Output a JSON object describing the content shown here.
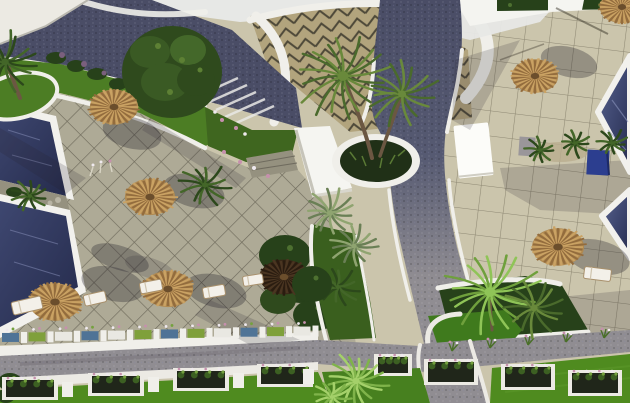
{
  "palette": {
    "sky": "#e7e8e6",
    "roofWhite": "#f5f5f1",
    "buildingWhite": "#eceae3",
    "roadDark": "#4a4d66",
    "gravel": "#908d92",
    "tileRBg": "#cbc5ac",
    "tileRLine": "#8e8873",
    "tileLBg": "#aeaa96",
    "tileLLine": "#6f6b5c",
    "chevBg": "#b2a47d",
    "chevLine": "#4e4939",
    "wallWhite": "#f0efea",
    "curbWhite": "#eceae4",
    "lawn": "#4c7d24",
    "lawnDark": "#3f661f",
    "lawnBright": "#4f8b1f",
    "hedge": "#27411a",
    "hedgeHi": "#4d7030",
    "poolHi": "#5b6590",
    "poolMid": "#3e4770",
    "poolLo": "#252b4c",
    "poolEdge": "#f2f1ed",
    "strawA": "#caa263",
    "strawB": "#936c3d",
    "strawBase": "#b08a52",
    "knob": "#6b4e2c",
    "darkUmbA": "#4a3521",
    "darkUmbB": "#2a1c10",
    "darkUmbBase": "#382817",
    "trunk": "#6b5742",
    "stone": "#95917f",
    "blueBox": "#2c3e8f",
    "tealBox": "#4f7396",
    "greenBox": "#7fa03b",
    "whiteBox": "#e9e8e2",
    "boxDark": "#20261a",
    "plantGreen": "#3c6022",
    "plantLight": "#74a13e",
    "flowerPink": "#c690ad",
    "flowerWhite": "#efe9ee",
    "shadow": "rgba(38,36,46,0.33)",
    "shadowSoft": "rgba(38,36,46,0.18)"
  },
  "palm_tones": {
    "dark": [
      "#2c481b",
      "#436628"
    ],
    "olive": [
      "#4a6a2c",
      "#69893b"
    ],
    "silver": [
      "#6a7f55",
      "#8fa470"
    ],
    "bright": [
      "#6fa03c",
      "#8fc457"
    ],
    "fan": [
      "#7fb34a",
      "#a4d06a"
    ]
  },
  "umbrellas": [
    {
      "x": 114,
      "y": 107,
      "r": 26,
      "tone": "straw",
      "sx": 18,
      "sy": 26
    },
    {
      "x": 150,
      "y": 197,
      "r": 27,
      "tone": "straw",
      "sx": 44,
      "sy": -6
    },
    {
      "x": 55,
      "y": 302,
      "r": 28,
      "tone": "straw",
      "sx": 58,
      "sy": -18
    },
    {
      "x": 168,
      "y": 289,
      "r": 27,
      "tone": "straw",
      "sx": 48,
      "sy": 2
    },
    {
      "x": 284,
      "y": 277,
      "r": 26,
      "tone": "dark"
    },
    {
      "x": 535,
      "y": 76,
      "r": 25,
      "tone": "straw",
      "sx": 34,
      "sy": -14
    },
    {
      "x": 622,
      "y": 7,
      "r": 24,
      "tone": "straw"
    },
    {
      "x": 558,
      "y": 247,
      "r": 28,
      "tone": "straw",
      "sx": 40,
      "sy": 10
    }
  ],
  "loungers": [
    {
      "x": 12,
      "y": 299,
      "w": 30,
      "h": 13,
      "rot": -13
    },
    {
      "x": 84,
      "y": 293,
      "w": 22,
      "h": 11,
      "rot": -13
    },
    {
      "x": 140,
      "y": 281,
      "w": 22,
      "h": 11,
      "rot": -11
    },
    {
      "x": 203,
      "y": 286,
      "w": 22,
      "h": 11,
      "rot": -10
    },
    {
      "x": 243,
      "y": 275,
      "w": 20,
      "h": 10,
      "rot": -9
    },
    {
      "x": 584,
      "y": 268,
      "w": 27,
      "h": 12,
      "rot": 7
    }
  ],
  "palms": [
    {
      "x": 5,
      "y": 62,
      "r": 32,
      "tone": "dark",
      "n": 15
    },
    {
      "x": 343,
      "y": 76,
      "r": 46,
      "tone": "olive",
      "n": 18
    },
    {
      "x": 402,
      "y": 94,
      "r": 34,
      "tone": "olive",
      "n": 15
    },
    {
      "x": 205,
      "y": 185,
      "r": 24,
      "tone": "dark",
      "n": 12
    },
    {
      "x": 330,
      "y": 213,
      "r": 26,
      "tone": "silver",
      "n": 14
    },
    {
      "x": 354,
      "y": 246,
      "r": 22,
      "tone": "silver",
      "n": 13
    },
    {
      "x": 338,
      "y": 287,
      "r": 20,
      "tone": "dark",
      "n": 12
    },
    {
      "x": 30,
      "y": 196,
      "r": 18,
      "tone": "dark",
      "n": 11
    },
    {
      "x": 490,
      "y": 292,
      "r": 46,
      "tone": "bright",
      "n": 18
    },
    {
      "x": 534,
      "y": 308,
      "r": 30,
      "tone": "olive",
      "n": 13
    },
    {
      "x": 540,
      "y": 150,
      "r": 14,
      "tone": "dark",
      "n": 10
    },
    {
      "x": 575,
      "y": 143,
      "r": 15,
      "tone": "dark",
      "n": 10
    },
    {
      "x": 612,
      "y": 143,
      "r": 15,
      "tone": "dark",
      "n": 10
    },
    {
      "x": 356,
      "y": 381,
      "r": 30,
      "tone": "fan",
      "n": 17
    },
    {
      "x": 332,
      "y": 397,
      "r": 18,
      "tone": "fan",
      "n": 12
    }
  ],
  "planter_boxes": {
    "mini_band_colors": [
      "teal",
      "green",
      "white",
      "teal",
      "white",
      "green",
      "teal",
      "green",
      "white",
      "teal",
      "green",
      "white"
    ],
    "mini_band_x0": 2,
    "mini_band_step": 26.5,
    "lower_left": [
      {
        "x": 6,
        "y": 380,
        "w": 48,
        "h": 17
      },
      {
        "x": 92,
        "y": 376,
        "w": 48,
        "h": 17
      },
      {
        "x": 177,
        "y": 371,
        "w": 48,
        "h": 17
      },
      {
        "x": 261,
        "y": 367,
        "w": 48,
        "h": 17
      }
    ],
    "lower_left_posts": [
      {
        "x": 62,
        "y": 382,
        "w": 11,
        "h": 15
      },
      {
        "x": 148,
        "y": 377,
        "w": 11,
        "h": 15
      },
      {
        "x": 233,
        "y": 373,
        "w": 11,
        "h": 15
      },
      {
        "x": 303,
        "y": 369,
        "w": 11,
        "h": 15
      }
    ],
    "right": [
      {
        "x": 378,
        "y": 357,
        "w": 30,
        "h": 16
      },
      {
        "x": 428,
        "y": 362,
        "w": 46,
        "h": 20
      },
      {
        "x": 505,
        "y": 367,
        "w": 46,
        "h": 20
      },
      {
        "x": 572,
        "y": 373,
        "w": 46,
        "h": 20
      }
    ]
  },
  "sprigs": [
    [
      452,
      351
    ],
    [
      490,
      348
    ],
    [
      528,
      345
    ],
    [
      566,
      342
    ],
    [
      604,
      338
    ]
  ]
}
